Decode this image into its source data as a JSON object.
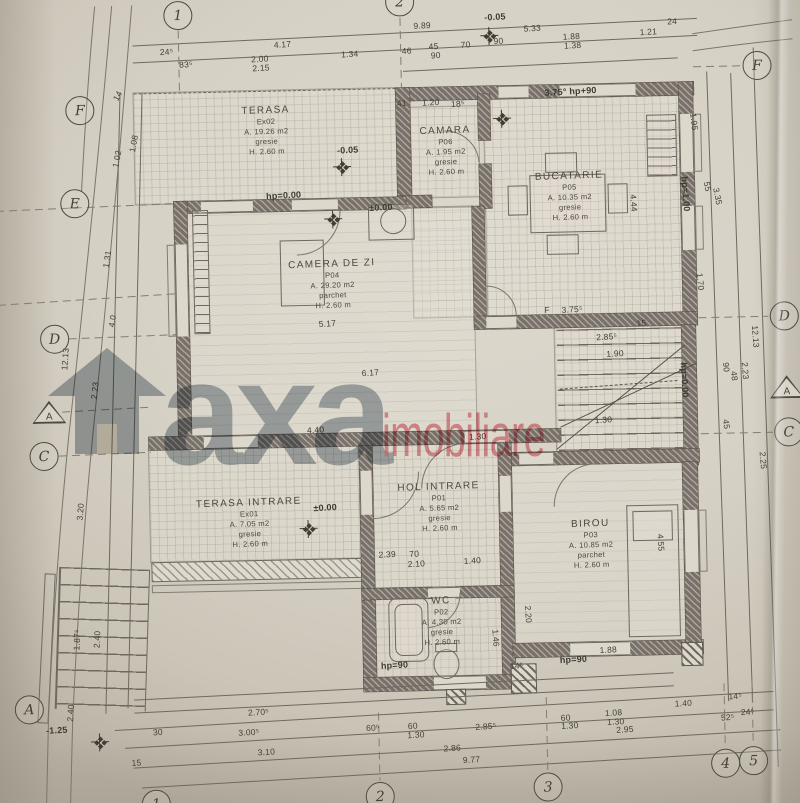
{
  "watermark": {
    "icon": "house-icon",
    "text_gray": "axa",
    "text_red": "imobiliare",
    "color_gray": "#96a0ab",
    "color_red": "#df5364"
  },
  "rooms": [
    {
      "id": "terasa",
      "name": "TERASA",
      "code": "Ex02",
      "area": "A. 19.26 m2",
      "finish": "gresie",
      "height": "H. 2.60 m",
      "x": 272,
      "y": 128
    },
    {
      "id": "camara",
      "name": "CAMARA",
      "code": "P06",
      "area": "A. 1.95 m2",
      "finish": "gresie",
      "height": "H. 2.60 m",
      "x": 451,
      "y": 152
    },
    {
      "id": "bucatarie",
      "name": "BUCATARIE",
      "code": "P05",
      "area": "A. 10.35 m2",
      "finish": "gresie",
      "height": "H. 2.60 m",
      "x": 574,
      "y": 200
    },
    {
      "id": "camera-de-zi",
      "name": "CAMERA DE ZI",
      "code": "P04",
      "area": "A. 29.20 m2",
      "finish": "parchet",
      "height": "H. 2.60 m",
      "x": 335,
      "y": 283
    },
    {
      "id": "terasa-intrare",
      "name": "TERASA INTRARE",
      "code": "Ex01",
      "area": "A. 7.05 m2",
      "finish": "gresie",
      "height": "H. 2.60 m",
      "x": 247,
      "y": 520
    },
    {
      "id": "hol-intrare",
      "name": "HOL INTRARE",
      "code": "P01",
      "area": "A. 5.65 m2",
      "finish": "gresie",
      "height": "H. 2.60 m",
      "x": 437,
      "y": 508
    },
    {
      "id": "wc",
      "name": "WC",
      "code": "P02",
      "area": "A. 4.30 m2",
      "finish": "gresie",
      "height": "H. 2.60 m",
      "x": 437,
      "y": 622
    },
    {
      "id": "birou",
      "name": "BIROU",
      "code": "P03",
      "area": "A. 10.85 m2",
      "finish": "parchet",
      "height": "H. 2.60 m",
      "x": 588,
      "y": 548
    }
  ],
  "grid_markers": [
    {
      "label": "1",
      "x": 186,
      "y": 11,
      "shape": "circle"
    },
    {
      "label": "2",
      "x": 408,
      "y": 2,
      "shape": "circle"
    },
    {
      "label": "F",
      "x": 86,
      "y": 104,
      "shape": "circle"
    },
    {
      "label": "E",
      "x": 79,
      "y": 197,
      "shape": "circle"
    },
    {
      "label": "D",
      "x": 56,
      "y": 332,
      "shape": "circle"
    },
    {
      "label": "A",
      "x": 49,
      "y": 406,
      "shape": "tri"
    },
    {
      "label": "C",
      "x": 43,
      "y": 449,
      "shape": "circle"
    },
    {
      "label": "A",
      "x": 23,
      "y": 702,
      "shape": "circle"
    },
    {
      "label": "F",
      "x": 764,
      "y": 73,
      "shape": "circle"
    },
    {
      "label": "D",
      "x": 786,
      "y": 324,
      "shape": "circle"
    },
    {
      "label": "A",
      "x": 787,
      "y": 396,
      "shape": "tri"
    },
    {
      "label": "C",
      "x": 788,
      "y": 440,
      "shape": "circle"
    },
    {
      "label": "1",
      "x": 148,
      "y": 799,
      "shape": "circle"
    },
    {
      "label": "2",
      "x": 372,
      "y": 796,
      "shape": "circle"
    },
    {
      "label": "3",
      "x": 540,
      "y": 790,
      "shape": "circle"
    },
    {
      "label": "4",
      "x": 718,
      "y": 770,
      "shape": "circle"
    },
    {
      "label": "5",
      "x": 746,
      "y": 768,
      "shape": "circle"
    }
  ],
  "level_annotations": [
    {
      "t": "±0.00",
      "x": 323,
      "y": 506
    },
    {
      "t": "±0.00",
      "x": 385,
      "y": 207
    },
    {
      "t": "-0.05",
      "x": 353,
      "y": 149
    },
    {
      "t": "-0.05",
      "x": 503,
      "y": 19
    },
    {
      "t": "-1.25",
      "x": 50,
      "y": 723
    },
    {
      "t": "hp=0.00",
      "x": 288,
      "y": 193
    },
    {
      "t": "hp=0.00",
      "x": 685,
      "y": 386,
      "r": 88
    },
    {
      "t": "hp=90",
      "x": 389,
      "y": 665
    },
    {
      "t": "hp=90",
      "x": 568,
      "y": 663
    },
    {
      "t": "hp=1.00",
      "x": 690,
      "y": 200,
      "r": 87
    },
    {
      "t": "3.75° hp+90",
      "x": 577,
      "y": 95
    }
  ],
  "dimensions": [
    {
      "t": "9.89",
      "x": 430,
      "y": 26
    },
    {
      "t": "24⁵",
      "x": 174,
      "y": 47
    },
    {
      "t": "4.17",
      "x": 290,
      "y": 42
    },
    {
      "t": "5.33",
      "x": 540,
      "y": 31
    },
    {
      "t": "1.88",
      "x": 579,
      "y": 40
    },
    {
      "t": "1.38",
      "x": 580,
      "y": 49
    },
    {
      "t": "1.21",
      "x": 656,
      "y": 37
    },
    {
      "t": "24",
      "x": 680,
      "y": 27
    },
    {
      "t": "83⁵",
      "x": 193,
      "y": 60
    },
    {
      "t": "2.00",
      "x": 267,
      "y": 56
    },
    {
      "t": "2.15",
      "x": 268,
      "y": 65
    },
    {
      "t": "1.34",
      "x": 357,
      "y": 53
    },
    {
      "t": "46",
      "x": 414,
      "y": 51
    },
    {
      "t": "45",
      "x": 441,
      "y": 47
    },
    {
      "t": "90",
      "x": 443,
      "y": 56
    },
    {
      "t": "70",
      "x": 473,
      "y": 46
    },
    {
      "t": "90",
      "x": 506,
      "y": 43
    },
    {
      "t": "41",
      "x": 408,
      "y": 103
    },
    {
      "t": "1.20",
      "x": 437,
      "y": 103
    },
    {
      "t": "18⁵",
      "x": 464,
      "y": 105
    },
    {
      "t": "1.95",
      "x": 700,
      "y": 128,
      "r": 85
    },
    {
      "t": "55",
      "x": 712,
      "y": 193,
      "r": 80
    },
    {
      "t": "3.35",
      "x": 722,
      "y": 203,
      "r": 80
    },
    {
      "t": "4.44",
      "x": 638,
      "y": 208,
      "r": 87
    },
    {
      "t": "1.70",
      "x": 703,
      "y": 288,
      "r": 85
    },
    {
      "t": "12.13",
      "x": 757,
      "y": 344,
      "r": 87
    },
    {
      "t": "90",
      "x": 727,
      "y": 374,
      "r": 85
    },
    {
      "t": "48",
      "x": 735,
      "y": 383,
      "r": 85
    },
    {
      "t": "2.23",
      "x": 746,
      "y": 378,
      "r": 87
    },
    {
      "t": "45",
      "x": 726,
      "y": 431,
      "r": 85
    },
    {
      "t": "2.25",
      "x": 762,
      "y": 468,
      "r": 87
    },
    {
      "t": "4.55",
      "x": 658,
      "y": 548,
      "r": 87
    },
    {
      "t": "2.20",
      "x": 524,
      "y": 617,
      "r": 87
    },
    {
      "t": "1.46",
      "x": 491,
      "y": 640,
      "r": 87
    },
    {
      "t": "5.17",
      "x": 329,
      "y": 322
    },
    {
      "t": "6.17",
      "x": 371,
      "y": 372
    },
    {
      "t": "4.40",
      "x": 315,
      "y": 428
    },
    {
      "t": "1.30",
      "x": 477,
      "y": 438
    },
    {
      "t": "F",
      "x": 549,
      "y": 313
    },
    {
      "t": "3.75⁵",
      "x": 574,
      "y": 313
    },
    {
      "t": "15",
      "x": 643,
      "y": 328
    },
    {
      "t": "2.85⁵",
      "x": 608,
      "y": 341
    },
    {
      "t": "1.90",
      "x": 616,
      "y": 358
    },
    {
      "t": "1.30",
      "x": 603,
      "y": 424
    },
    {
      "t": "2.39",
      "x": 384,
      "y": 554
    },
    {
      "t": "70",
      "x": 411,
      "y": 554
    },
    {
      "t": "2.10",
      "x": 413,
      "y": 564
    },
    {
      "t": "1.40",
      "x": 469,
      "y": 562
    },
    {
      "t": "14",
      "x": 124,
      "y": 90,
      "r": -60
    },
    {
      "t": "1.08",
      "x": 139,
      "y": 138,
      "r": -78
    },
    {
      "t": "1.02",
      "x": 122,
      "y": 153,
      "r": -78
    },
    {
      "t": "1.31",
      "x": 110,
      "y": 253,
      "r": -80
    },
    {
      "t": "4.0",
      "x": 114,
      "y": 315,
      "r": -80
    },
    {
      "t": "12.13",
      "x": 66,
      "y": 352,
      "r": -85
    },
    {
      "t": "2.23",
      "x": 95,
      "y": 384,
      "r": -83
    },
    {
      "t": "3.20",
      "x": 78,
      "y": 505,
      "r": -84
    },
    {
      "t": "1.87⁵",
      "x": 72,
      "y": 633,
      "r": -86
    },
    {
      "t": "2.40",
      "x": 92,
      "y": 633,
      "r": -86
    },
    {
      "t": "2.40",
      "x": 64,
      "y": 706,
      "r": -86
    },
    {
      "t": "30",
      "x": 151,
      "y": 727
    },
    {
      "t": "2.70⁵",
      "x": 252,
      "y": 709
    },
    {
      "t": "3.00⁵",
      "x": 242,
      "y": 729
    },
    {
      "t": "3.10",
      "x": 259,
      "y": 749
    },
    {
      "t": "15",
      "x": 129,
      "y": 757
    },
    {
      "t": "60⁵",
      "x": 366,
      "y": 727
    },
    {
      "t": "60",
      "x": 406,
      "y": 726
    },
    {
      "t": "1.30",
      "x": 409,
      "y": 735
    },
    {
      "t": "2.86",
      "x": 445,
      "y": 749
    },
    {
      "t": "2.85⁵",
      "x": 479,
      "y": 728
    },
    {
      "t": "9.77",
      "x": 464,
      "y": 761
    },
    {
      "t": "60",
      "x": 559,
      "y": 721
    },
    {
      "t": "1.30",
      "x": 563,
      "y": 729
    },
    {
      "t": "1.08",
      "x": 607,
      "y": 717
    },
    {
      "t": "1.30",
      "x": 609,
      "y": 726
    },
    {
      "t": "2.95",
      "x": 618,
      "y": 734
    },
    {
      "t": "1.88",
      "x": 603,
      "y": 654
    },
    {
      "t": "14⁵",
      "x": 511,
      "y": 668
    },
    {
      "t": "1.40",
      "x": 677,
      "y": 709
    },
    {
      "t": "14⁵",
      "x": 729,
      "y": 703
    },
    {
      "t": "52⁵",
      "x": 721,
      "y": 724
    },
    {
      "t": "24⁵",
      "x": 741,
      "y": 719
    }
  ],
  "crosses": [
    {
      "x": 347,
      "y": 166
    },
    {
      "x": 337,
      "y": 218
    },
    {
      "x": 508,
      "y": 121
    },
    {
      "x": 306,
      "y": 527
    },
    {
      "x": 93,
      "y": 736
    },
    {
      "x": 497,
      "y": 38
    }
  ]
}
